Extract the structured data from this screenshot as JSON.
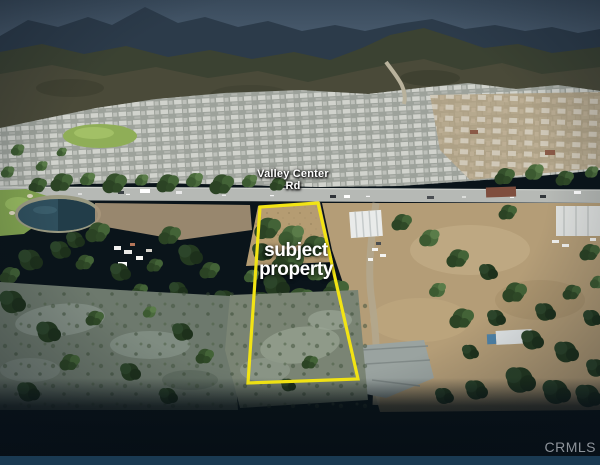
{
  "photo": {
    "kind": "aerial-listing-photo",
    "road_label": "Valley Center Rd",
    "property_label": "subject\nproperty",
    "watermark": "CRMLS",
    "colors": {
      "boundary": "#f2e414",
      "label_text": "#ffffff",
      "watermark_text": "#8d939a",
      "sky": "#4c5e70",
      "bottom_bar": "#1a3a52"
    },
    "scene_features": [
      "mountain ridges and slate-blue sky",
      "hillside housing development with gray rooftops",
      "green park patch in development",
      "Valley Center Rd running across the frame",
      "golf course green and pond at left",
      "vacant tree-covered subject parcel outlined in yellow",
      "dirt lots, warehouse and outbuildings at right",
      "rocky wash foreground fading into dark bottom band"
    ]
  }
}
